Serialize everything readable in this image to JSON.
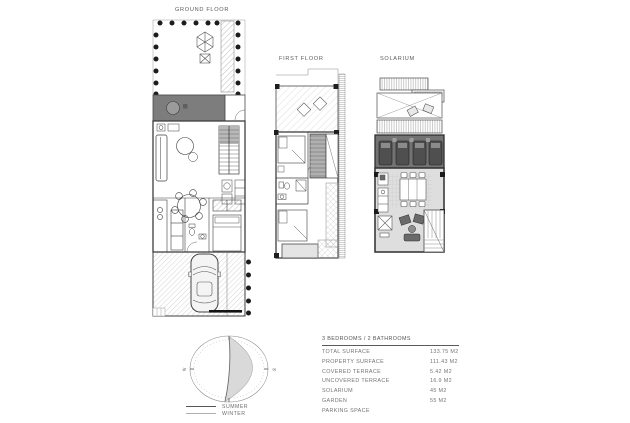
{
  "plans": {
    "ground_floor": {
      "title": "GROUND FLOOR"
    },
    "first_floor": {
      "title": "FIRST FLOOR"
    },
    "solarium": {
      "title": "SOLARIUM"
    }
  },
  "sun_diagram": {
    "north_label": "N",
    "south_label": "S",
    "legend": [
      {
        "label": "SUMMER"
      },
      {
        "label": "WINTER"
      }
    ]
  },
  "summary_table": {
    "header": "3 BEDROOMS / 2 BATHROOMS",
    "rows": [
      {
        "label": "TOTAL SURFACE",
        "value": "133.75 M2"
      },
      {
        "label": "PROPERTY SURFACE",
        "value": "111.43 M2"
      },
      {
        "label": "COVERED TERRACE",
        "value": "5.42 M2"
      },
      {
        "label": "UNCOVERED TERRACE",
        "value": "16.9 M2"
      },
      {
        "label": "SOLARIUM",
        "value": "45 M2"
      },
      {
        "label": "GARDEN",
        "value": "55 M2"
      },
      {
        "label": "PARKING SPACE",
        "value": ""
      }
    ]
  },
  "colors": {
    "line": "#555555",
    "dark_terrace": "#7d7d7d",
    "sun_deck": "#737373",
    "light_terrace": "#dedede",
    "crescent": "#d9d9d9",
    "text": "#6e6e6e"
  }
}
